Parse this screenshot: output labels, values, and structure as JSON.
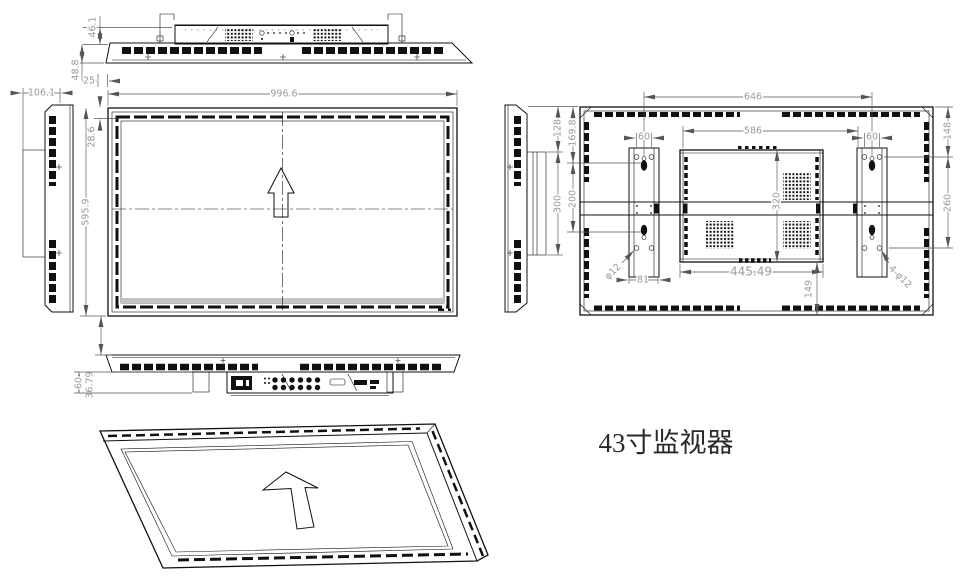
{
  "title": "43寸监视器",
  "dims": {
    "top": {
      "raised": "46.1",
      "total": "48.8",
      "offset": "25"
    },
    "side_left": {
      "depth": "106.1"
    },
    "front": {
      "width": "996.6",
      "bezel": "28.6",
      "height": "595.9"
    },
    "bottom": {
      "gap": "36.79",
      "base": "60"
    },
    "side_right": {
      "top_offset": "128",
      "bracket_span": "300"
    },
    "back": {
      "centers": "646",
      "inner": "586",
      "holes_left": "60",
      "holes_right": "60",
      "top_left": "169.8",
      "pitch_left": "200",
      "top_right": "148",
      "pitch_right": "260",
      "box_height": "320",
      "box_width": "445.49",
      "bottom_gap": "149",
      "bracket_width": "81",
      "hole_left": "φ12",
      "hole_right": "4-φ12"
    }
  }
}
